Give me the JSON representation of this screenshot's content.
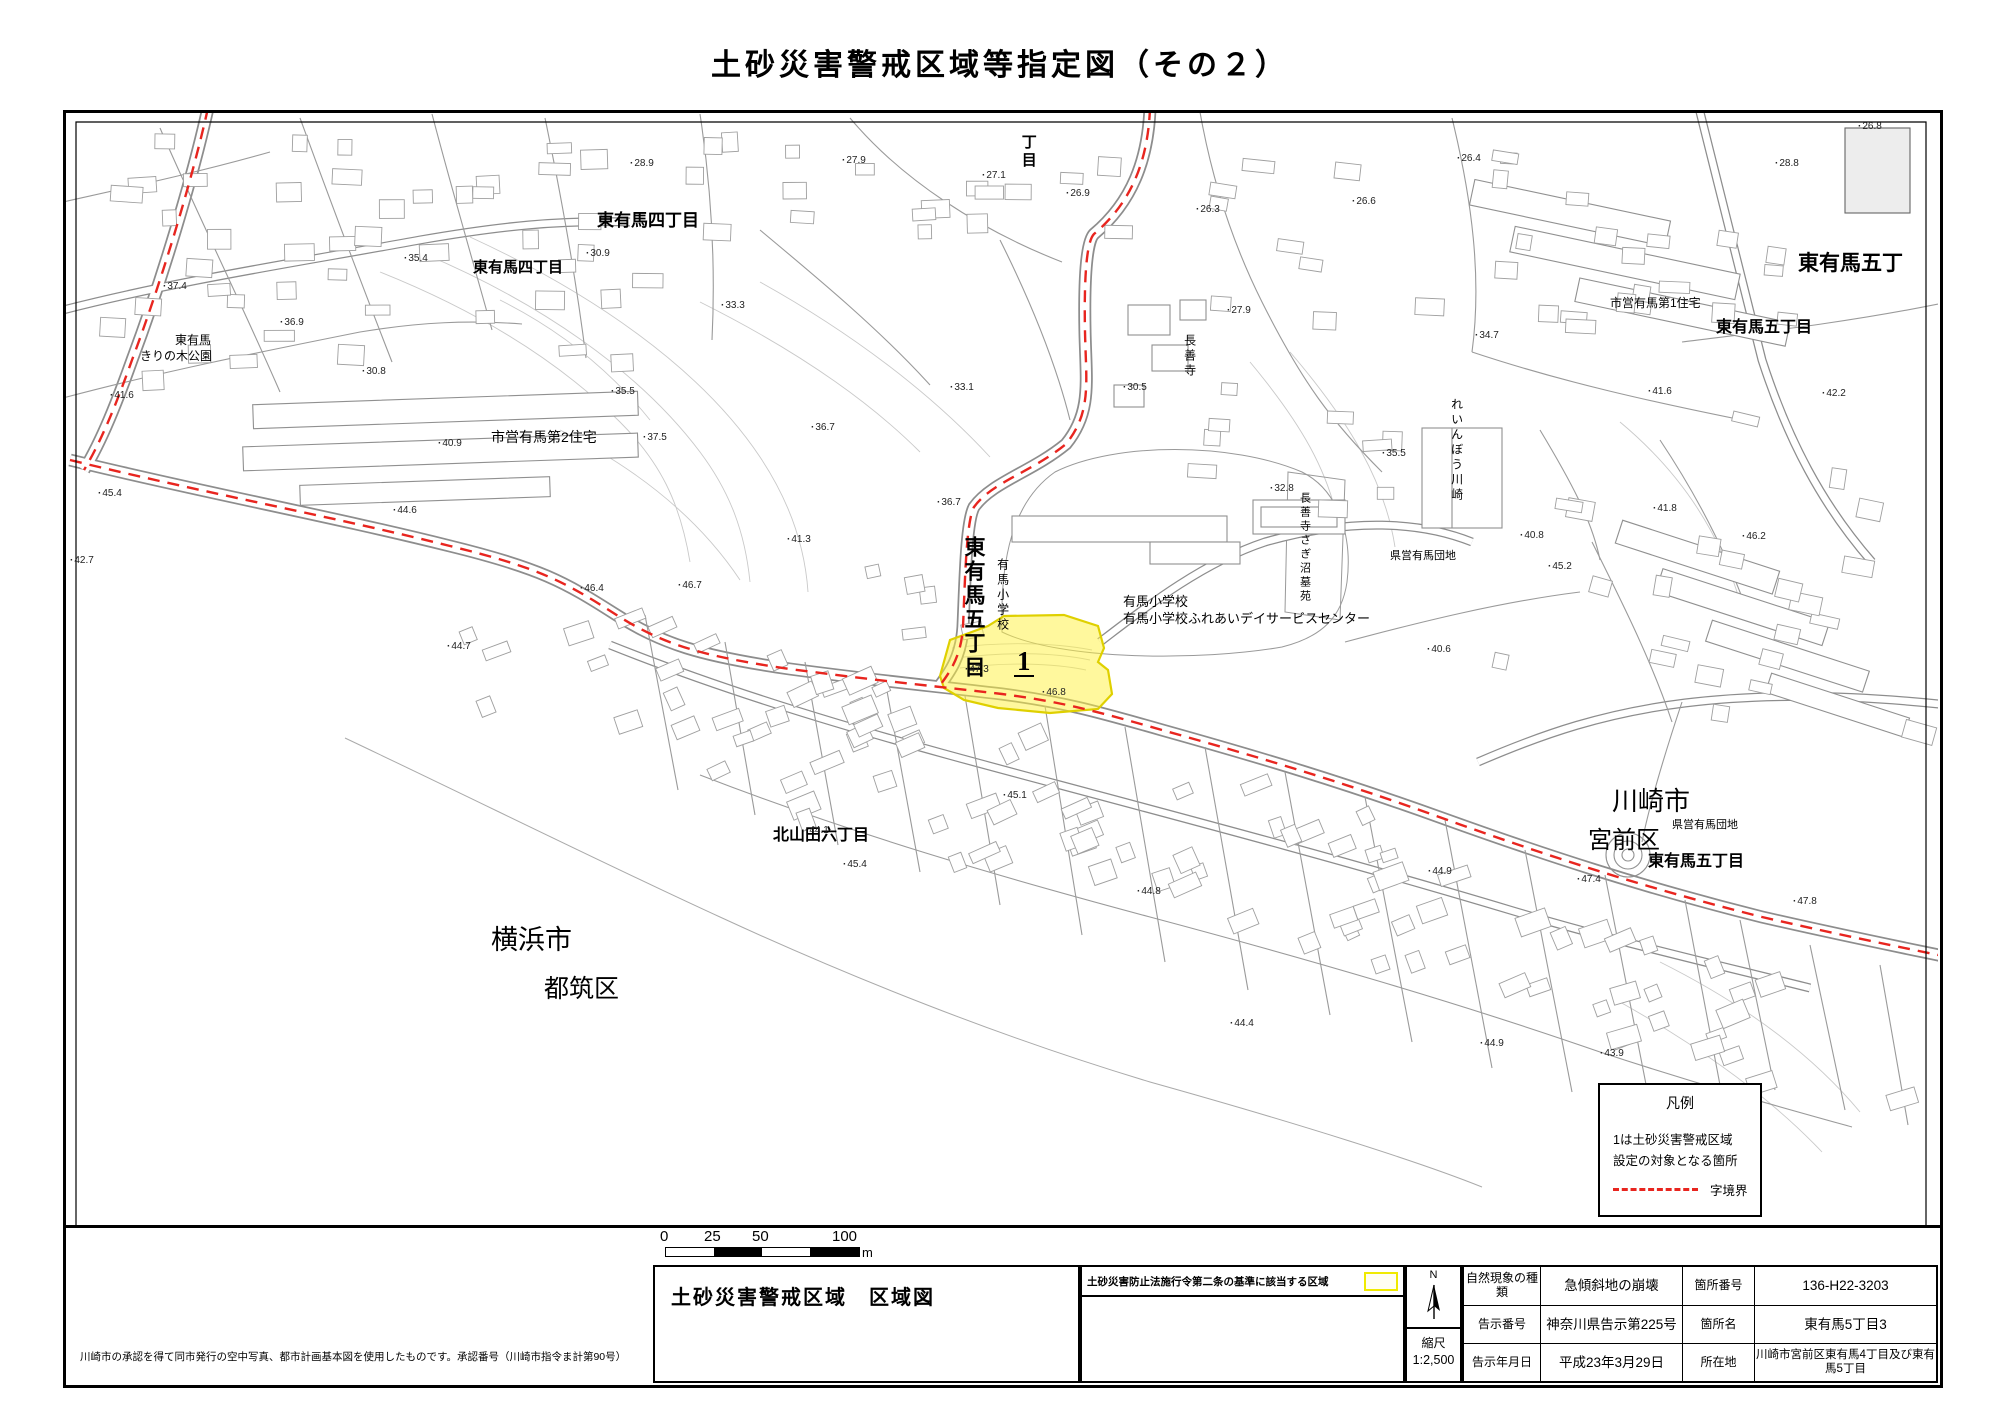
{
  "page_title": "土砂災害警戒区域等指定図（その２）",
  "map": {
    "warning_area_number": "1",
    "boundary_color": "#e8251f",
    "warning_fill": "#fff23c",
    "place_labels": [
      {
        "t": "東有馬四丁目",
        "x": 597,
        "y": 212,
        "s": 17,
        "b": 1
      },
      {
        "t": "東有馬四丁目",
        "x": 473,
        "y": 260,
        "s": 15,
        "b": 1
      },
      {
        "t": "東有馬五丁",
        "x": 1798,
        "y": 253,
        "s": 21,
        "b": 1
      },
      {
        "t": "東有馬五丁目",
        "x": 1716,
        "y": 320,
        "s": 16,
        "b": 1
      },
      {
        "t": "市営有馬第1住宅",
        "x": 1610,
        "y": 297,
        "s": 12
      },
      {
        "t": "市営有馬第2住宅",
        "x": 491,
        "y": 430,
        "s": 14
      },
      {
        "t": "東有馬",
        "x": 175,
        "y": 334,
        "s": 12
      },
      {
        "t": "きりの木公園",
        "x": 140,
        "y": 350,
        "s": 12
      },
      {
        "t": "長善寺",
        "x": 1183,
        "y": 334,
        "s": 12,
        "v": 1
      },
      {
        "t": "れいんぼう川崎",
        "x": 1450,
        "y": 398,
        "s": 12,
        "v": 1
      },
      {
        "t": "長善寺さぎ沼墓苑",
        "x": 1298,
        "y": 492,
        "s": 11,
        "v": 1
      },
      {
        "t": "東有馬五丁目",
        "x": 962,
        "y": 536,
        "s": 21,
        "b": 1,
        "v": 1
      },
      {
        "t": "有馬小学校",
        "x": 996,
        "y": 558,
        "s": 12,
        "v": 1
      },
      {
        "t": "丁目",
        "x": 1020,
        "y": 134,
        "s": 15,
        "b": 1,
        "v": 1
      },
      {
        "t": "有馬小学校",
        "x": 1123,
        "y": 595,
        "s": 13
      },
      {
        "t": "有馬小学校ふれあいデイサービスセンター",
        "x": 1123,
        "y": 612,
        "s": 13
      },
      {
        "t": "県営有馬団地",
        "x": 1390,
        "y": 551,
        "s": 11
      },
      {
        "t": "県営有馬団地",
        "x": 1672,
        "y": 820,
        "s": 11
      },
      {
        "t": "北山田六丁目",
        "x": 773,
        "y": 828,
        "s": 16,
        "b": 1
      },
      {
        "t": "横浜市",
        "x": 491,
        "y": 926,
        "s": 27
      },
      {
        "t": "都筑区",
        "x": 544,
        "y": 976,
        "s": 25
      },
      {
        "t": "川崎市",
        "x": 1612,
        "y": 788,
        "s": 26
      },
      {
        "t": "宮前区",
        "x": 1588,
        "y": 828,
        "s": 24
      },
      {
        "t": "東有馬五丁目",
        "x": 1648,
        "y": 854,
        "s": 16,
        "b": 1
      }
    ],
    "elevation_points": [
      {
        "x": 630,
        "y": 158,
        "v": "28.9"
      },
      {
        "x": 842,
        "y": 155,
        "v": "27.9"
      },
      {
        "x": 982,
        "y": 170,
        "v": "27.1"
      },
      {
        "x": 1066,
        "y": 188,
        "v": "26.9"
      },
      {
        "x": 1196,
        "y": 204,
        "v": "26.3"
      },
      {
        "x": 1352,
        "y": 196,
        "v": "26.6"
      },
      {
        "x": 1457,
        "y": 153,
        "v": "26.4"
      },
      {
        "x": 1775,
        "y": 158,
        "v": "28.8"
      },
      {
        "x": 1858,
        "y": 121,
        "v": "26.8"
      },
      {
        "x": 163,
        "y": 281,
        "v": "37.4"
      },
      {
        "x": 110,
        "y": 390,
        "v": "41.6"
      },
      {
        "x": 280,
        "y": 317,
        "v": "36.9"
      },
      {
        "x": 404,
        "y": 253,
        "v": "35.4"
      },
      {
        "x": 586,
        "y": 248,
        "v": "30.9"
      },
      {
        "x": 721,
        "y": 300,
        "v": "33.3"
      },
      {
        "x": 362,
        "y": 366,
        "v": "30.8"
      },
      {
        "x": 611,
        "y": 386,
        "v": "35.5"
      },
      {
        "x": 950,
        "y": 382,
        "v": "33.1"
      },
      {
        "x": 1123,
        "y": 382,
        "v": "30.5"
      },
      {
        "x": 1227,
        "y": 305,
        "v": "27.9"
      },
      {
        "x": 1475,
        "y": 330,
        "v": "34.7"
      },
      {
        "x": 1382,
        "y": 448,
        "v": "35.5"
      },
      {
        "x": 1270,
        "y": 483,
        "v": "32.8"
      },
      {
        "x": 937,
        "y": 497,
        "v": "36.7"
      },
      {
        "x": 811,
        "y": 422,
        "v": "36.7"
      },
      {
        "x": 438,
        "y": 438,
        "v": "40.9"
      },
      {
        "x": 393,
        "y": 505,
        "v": "44.6"
      },
      {
        "x": 643,
        "y": 432,
        "v": "37.5"
      },
      {
        "x": 580,
        "y": 583,
        "v": "46.4"
      },
      {
        "x": 447,
        "y": 641,
        "v": "44.7"
      },
      {
        "x": 787,
        "y": 534,
        "v": "41.3"
      },
      {
        "x": 98,
        "y": 488,
        "v": "45.4"
      },
      {
        "x": 70,
        "y": 555,
        "v": "42.7"
      },
      {
        "x": 678,
        "y": 580,
        "v": "46.7"
      },
      {
        "x": 965,
        "y": 664,
        "v": "47.3"
      },
      {
        "x": 1042,
        "y": 687,
        "v": "46.8"
      },
      {
        "x": 1427,
        "y": 644,
        "v": "40.6"
      },
      {
        "x": 1520,
        "y": 530,
        "v": "40.8"
      },
      {
        "x": 1653,
        "y": 503,
        "v": "41.8"
      },
      {
        "x": 1822,
        "y": 388,
        "v": "42.2"
      },
      {
        "x": 1648,
        "y": 386,
        "v": "41.6"
      },
      {
        "x": 1548,
        "y": 561,
        "v": "45.2"
      },
      {
        "x": 1742,
        "y": 531,
        "v": "46.2"
      },
      {
        "x": 1428,
        "y": 866,
        "v": "44.9"
      },
      {
        "x": 1577,
        "y": 874,
        "v": "47.4"
      },
      {
        "x": 1793,
        "y": 896,
        "v": "47.8"
      },
      {
        "x": 1480,
        "y": 1038,
        "v": "44.9"
      },
      {
        "x": 1600,
        "y": 1048,
        "v": "43.9"
      },
      {
        "x": 843,
        "y": 859,
        "v": "45.4"
      },
      {
        "x": 1137,
        "y": 886,
        "v": "44.8"
      },
      {
        "x": 1003,
        "y": 790,
        "v": "45.1"
      },
      {
        "x": 1230,
        "y": 1018,
        "v": "44.4"
      },
      {
        "x": 805,
        "y": 825,
        "v": "44.1"
      }
    ]
  },
  "legend": {
    "title": "凡例",
    "line1": "1は土砂災害警戒区域",
    "line2": "設定の対象となる箇所",
    "boundary_label": "字境界"
  },
  "scalebar": {
    "tick0": "0",
    "tick25": "25",
    "tick50": "50",
    "tick100": "100",
    "unit": "m"
  },
  "footer": {
    "note": "川崎市の承認を得て同市発行の空中写真、都市計画基本図を使用したものです。承認番号（川崎市指令ま計第90号）",
    "sheet_title": "土砂災害警戒区域　区域図",
    "criteria_label": "土砂災害防止法施行令第二条の基準に該当する区域",
    "compass_label": "N",
    "scale_label": "縮尺",
    "scale_value": "1:2,500",
    "table": {
      "rows": [
        {
          "k1": "自然現象の種類",
          "v1": "急傾斜地の崩壊",
          "k2": "箇所番号",
          "v2": "136-H22-3203"
        },
        {
          "k1": "告示番号",
          "v1": "神奈川県告示第225号",
          "k2": "箇所名",
          "v2": "東有馬5丁目3"
        },
        {
          "k1": "告示年月日",
          "v1": "平成23年3月29日",
          "k2": "所在地",
          "v2": "川崎市宮前区東有馬4丁目及び東有馬5丁目"
        }
      ]
    }
  }
}
